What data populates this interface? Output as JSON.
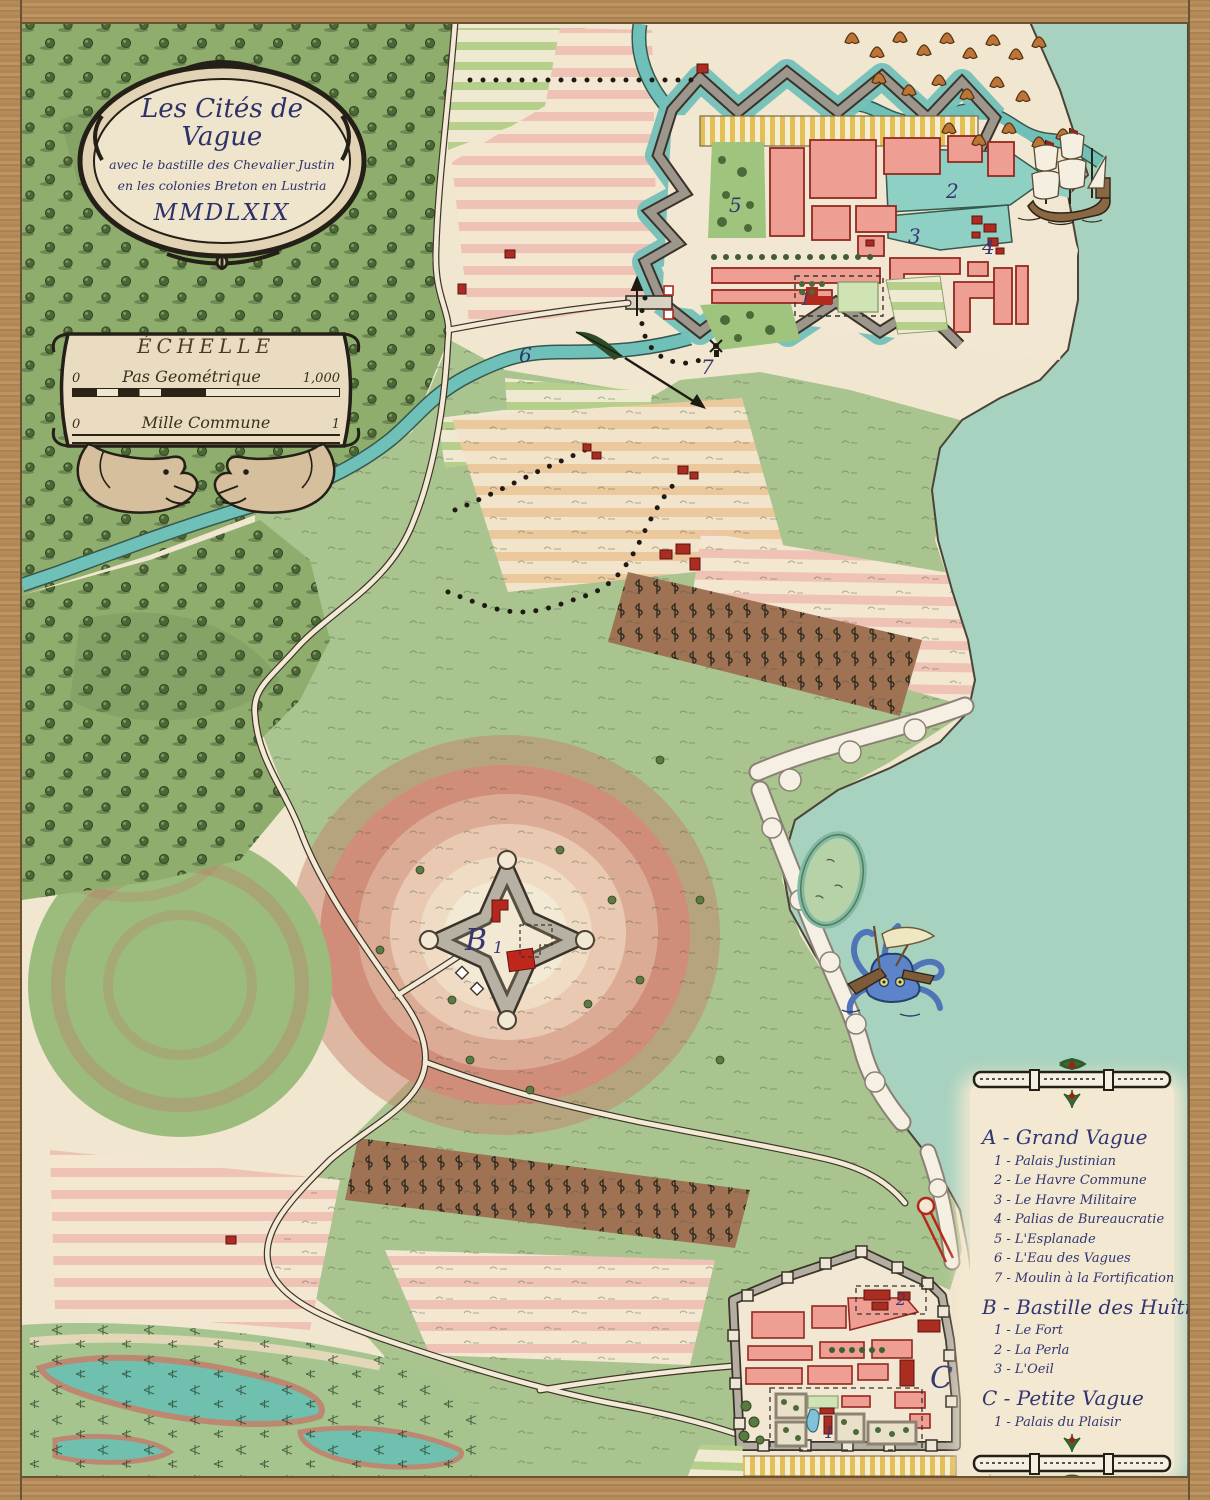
{
  "title_cartouche": {
    "title": "Les Cités de Vague",
    "subtitle1": "avec le bastille des Chevalier Justin",
    "subtitle2": "en les colonies Breton en Lustria",
    "year": "MMDLXIX"
  },
  "scale_cartouche": {
    "heading": "ÉCHELLE",
    "bar1": {
      "label": "Pas Geométrique",
      "start": "0",
      "end": "1,000"
    },
    "bar2": {
      "label": "Mille Commune",
      "start": "0",
      "end": "1"
    }
  },
  "legend": {
    "sections": [
      {
        "heading": "A - Grand Vague",
        "items": [
          "1 - Palais Justinian",
          "2 - Le Havre Commune",
          "3 - Le Havre Militaire",
          "4 - Palias de Bureaucratie",
          "5 - L'Esplanade",
          "6 - L'Eau des Vagues",
          "7 - Moulin à la Fortification"
        ]
      },
      {
        "heading": "B - Bastille des Huîtres",
        "items": [
          "1 - Le Fort",
          "2 - La Perla",
          "3 - L'Oeil"
        ]
      },
      {
        "heading": "C - Petite Vague",
        "items": [
          "1 - Palais du Plaisir"
        ]
      }
    ]
  },
  "map_labels": {
    "gv_1": "1",
    "gv_2": "2",
    "gv_3": "3",
    "gv_4": "4",
    "gv_5": "5",
    "gv_6": "6",
    "gv_7": "7",
    "b_letter": "B",
    "b_1": "1",
    "pv_letter": "C",
    "pv_1": "1",
    "pv_2": "2"
  },
  "colors": {
    "sea": "#a6d2bf",
    "river": "#6fc0b8",
    "parchment": "#f1e6cf",
    "forest": "#8fae6e",
    "pasture": "#a9c48f",
    "building_pink": "#ef9e93",
    "building_red": "#ab2d22",
    "wall_gray": "#9c968c",
    "label_ink": "#34386f",
    "wood_frame": "#b08a58",
    "field_pink": "#eec2b4",
    "field_orange": "#ecc89d",
    "field_green": "#b6cf8b",
    "stripe_yellow": "#e3bf55",
    "vineyard": "#9f7254"
  }
}
